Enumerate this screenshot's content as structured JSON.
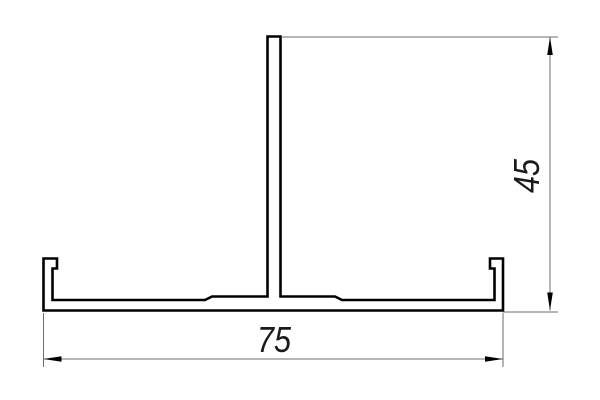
{
  "drawing": {
    "type": "aluminum-profile-cross-section",
    "background_color": "#ffffff",
    "outline_color": "#000000",
    "thin_line_color": "#6e6e6e",
    "text_color": "#1a1a1a",
    "dimensions": {
      "height": {
        "label": "45",
        "value": 45,
        "orientation": "vertical",
        "position": "right"
      },
      "width": {
        "label": "75",
        "value": 75,
        "orientation": "horizontal",
        "position": "bottom"
      }
    }
  }
}
